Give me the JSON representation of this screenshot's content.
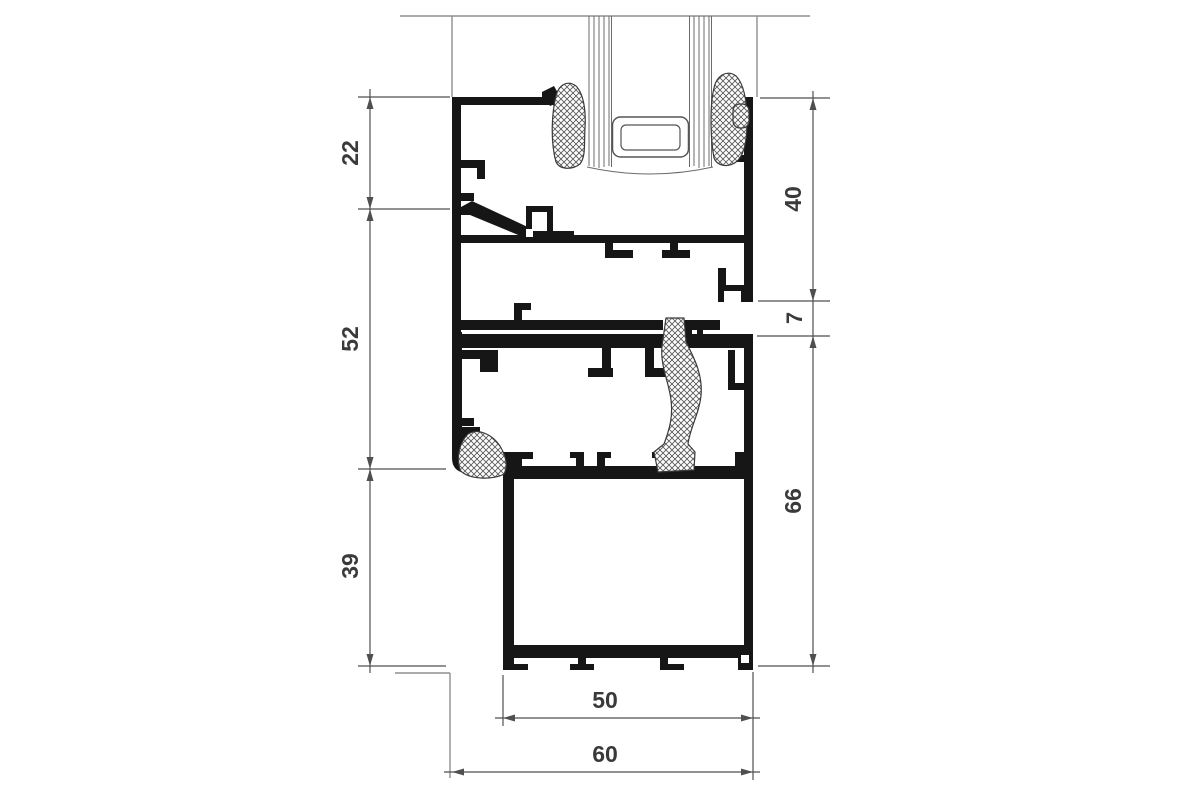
{
  "dims": {
    "left": [
      {
        "label": "22"
      },
      {
        "label": "52"
      },
      {
        "label": "39"
      }
    ],
    "right": [
      {
        "label": "40"
      },
      {
        "label": "7"
      },
      {
        "label": "66"
      }
    ],
    "bottom": [
      {
        "label": "50"
      },
      {
        "label": "60"
      }
    ]
  },
  "colors": {
    "profile": "#161616",
    "dimension_line": "#4f4f4f",
    "wall_line": "#8f8f8f",
    "glass_line": "#6b6b6b",
    "gasket_outline": "#3a3a3a",
    "text": "#3a3a3a",
    "background": "#ffffff"
  }
}
